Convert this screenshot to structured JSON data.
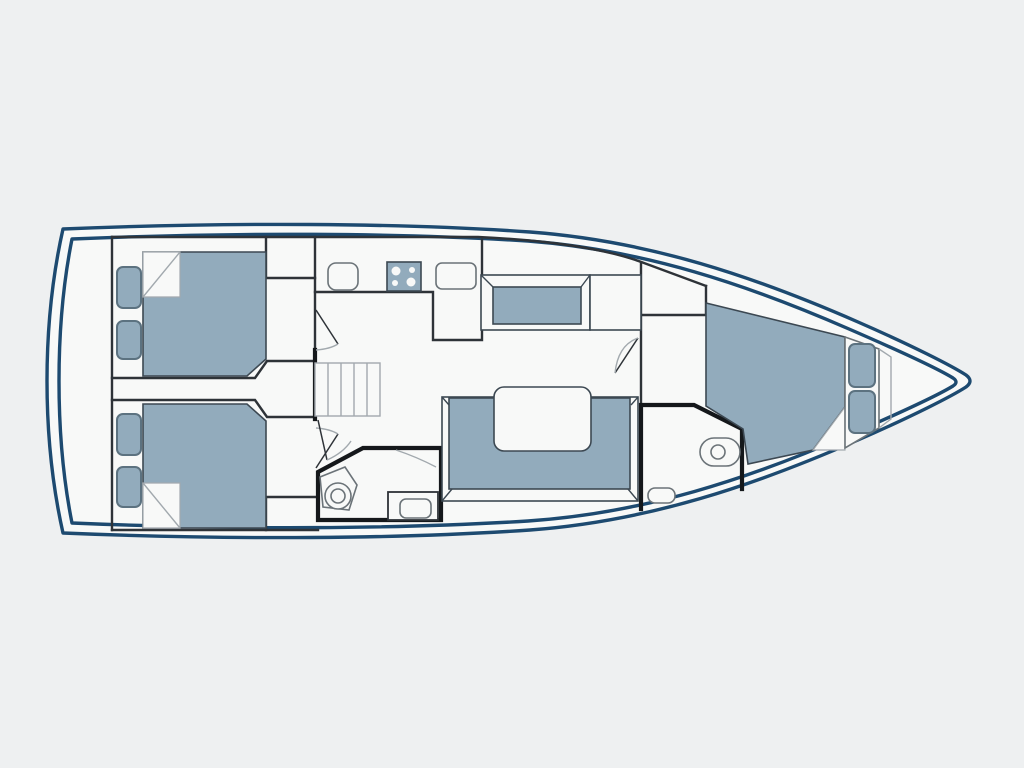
{
  "title": "Yacht interior deck floor plan",
  "canvas": {
    "width": 1024,
    "height": 768
  },
  "colors": {
    "background": "#eef0f1",
    "hull_outline": "#1d4a70",
    "floor": "#f8f9f8",
    "furniture_fill": "#92abbc",
    "furniture_border": "#3c4852",
    "pillow_border": "#5c7280",
    "wall": "#2e3338",
    "wall_thick": "#15181b",
    "fixture_line": "#6b7378",
    "light_line": "#a2a9ae"
  },
  "rooms": [
    {
      "id": "aft-cabin-port",
      "label": "aft cabin (top)",
      "furniture": [
        "double-bed",
        "pillow",
        "pillow",
        "wardrobe",
        "folded-sheet-corner"
      ]
    },
    {
      "id": "aft-cabin-starboard",
      "label": "aft cabin (bottom)",
      "furniture": [
        "double-bed",
        "pillow",
        "pillow",
        "wardrobe",
        "folded-sheet-corner"
      ]
    },
    {
      "id": "companionway",
      "label": "companionway stairs",
      "furniture": [
        "stairs-5-treads"
      ]
    },
    {
      "id": "galley",
      "label": "galley",
      "furniture": [
        "sink",
        "stove-4-burners",
        "sink",
        "l-shaped-counter"
      ]
    },
    {
      "id": "salon",
      "label": "salon",
      "furniture": [
        "side-bench",
        "cabinet",
        "u-shaped-sofa",
        "table"
      ]
    },
    {
      "id": "mid-head",
      "label": "bathroom (midship)",
      "furniture": [
        "toilet",
        "sink-counter"
      ]
    },
    {
      "id": "bow-head",
      "label": "bathroom (bow)",
      "furniture": [
        "toilet",
        "step"
      ]
    },
    {
      "id": "bow-cabin",
      "label": "bow cabin",
      "furniture": [
        "double-bed",
        "pillow",
        "pillow",
        "headboard",
        "folded-sheet-corner"
      ]
    }
  ]
}
